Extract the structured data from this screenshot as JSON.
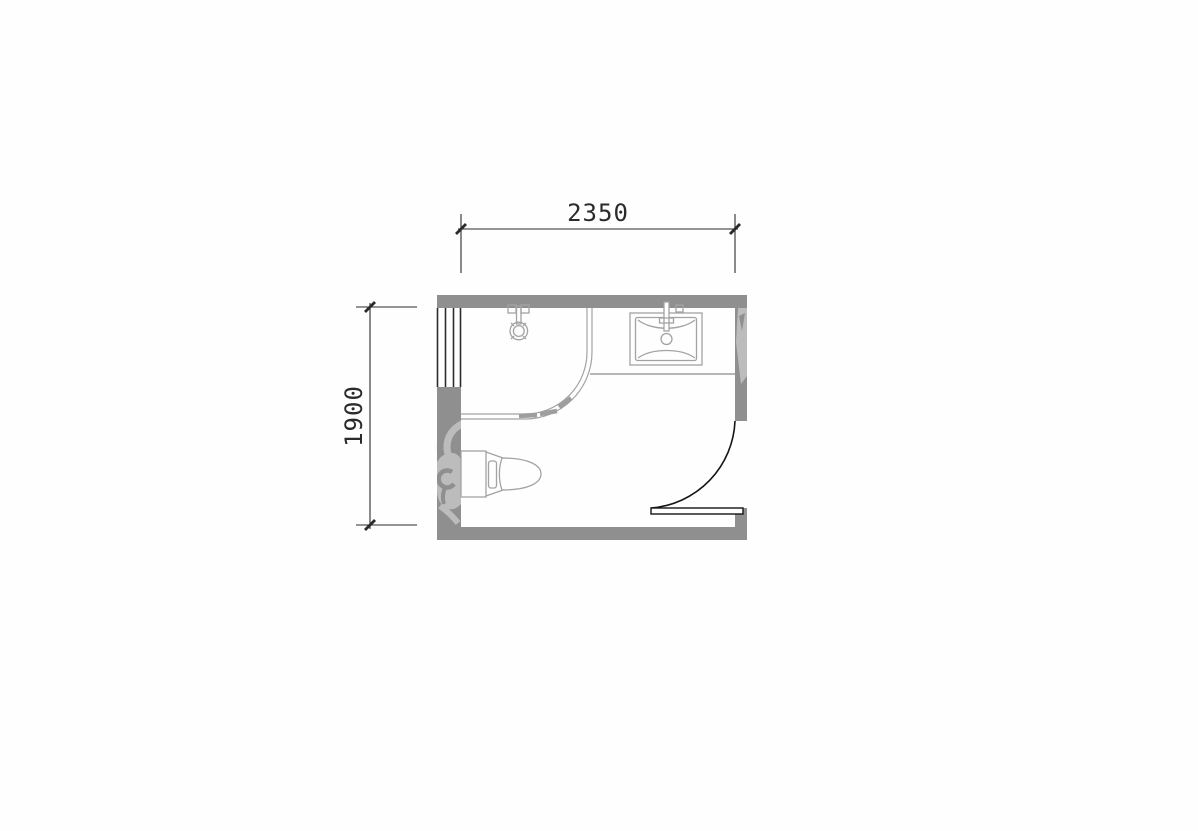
{
  "colors": {
    "background": "#fefefe",
    "wall": "#8f8f8f",
    "line_dark": "#2b2b2b",
    "fixture": "#a3a3a3",
    "counter": "#9d9d9d",
    "track_dash": "#9e9e9e",
    "door": "#141414",
    "watermark": "#bcbcbc",
    "watermark_faint": "#eaeaea"
  },
  "floor_plan": {
    "dimensions": {
      "horizontal": {
        "value": "2350"
      },
      "vertical": {
        "value": "1900"
      }
    },
    "fixtures": [
      "window-symbol",
      "shower-fixture-symbol",
      "shower-enclosure-symbol",
      "sink-symbol",
      "toilet-symbol",
      "door-swing-symbol"
    ]
  }
}
